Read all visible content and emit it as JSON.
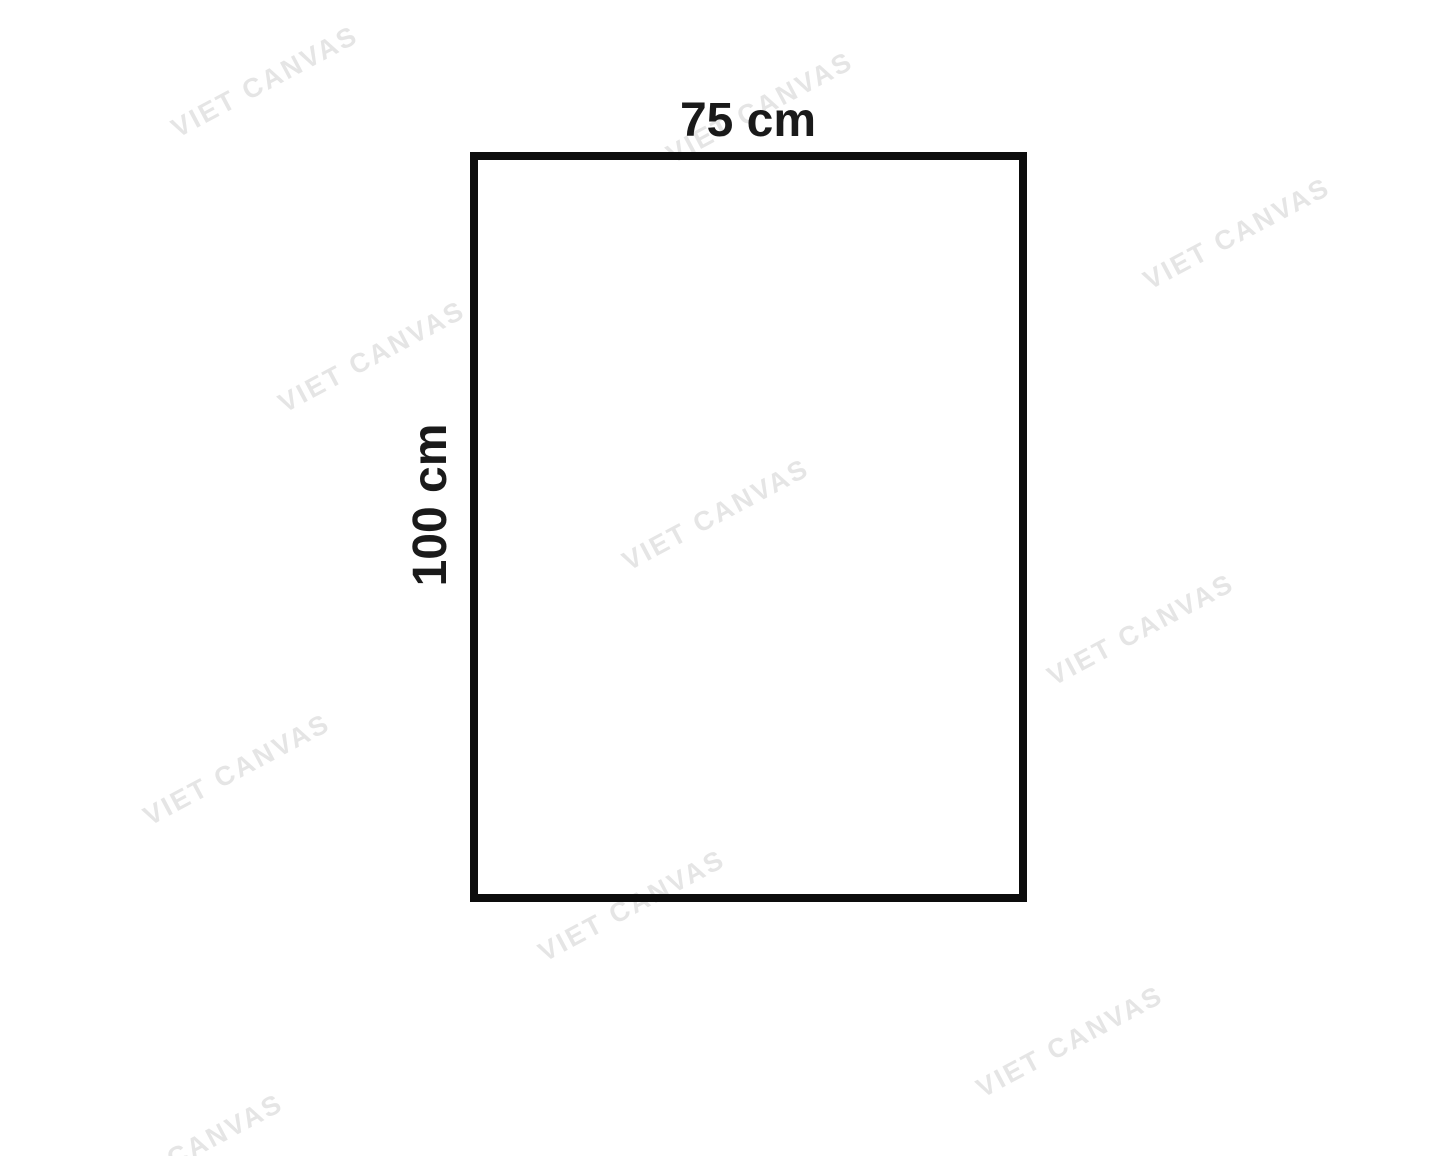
{
  "diagram": {
    "width_label": "75 cm",
    "height_label": "100 cm"
  },
  "watermark": {
    "text": "VIET CANVAS",
    "rotation_deg": -28,
    "color": "#e5e5e5",
    "positions": [
      {
        "x": 265,
        "y": 82
      },
      {
        "x": 760,
        "y": 108
      },
      {
        "x": 1237,
        "y": 234
      },
      {
        "x": 372,
        "y": 357
      },
      {
        "x": 716,
        "y": 515
      },
      {
        "x": 1141,
        "y": 630
      },
      {
        "x": 237,
        "y": 770
      },
      {
        "x": 632,
        "y": 906
      },
      {
        "x": 1070,
        "y": 1042
      },
      {
        "x": 190,
        "y": 1150
      }
    ]
  },
  "colors": {
    "background": "#ffffff",
    "outline": "#0d0d0d",
    "label_text": "#1a1a1a"
  }
}
